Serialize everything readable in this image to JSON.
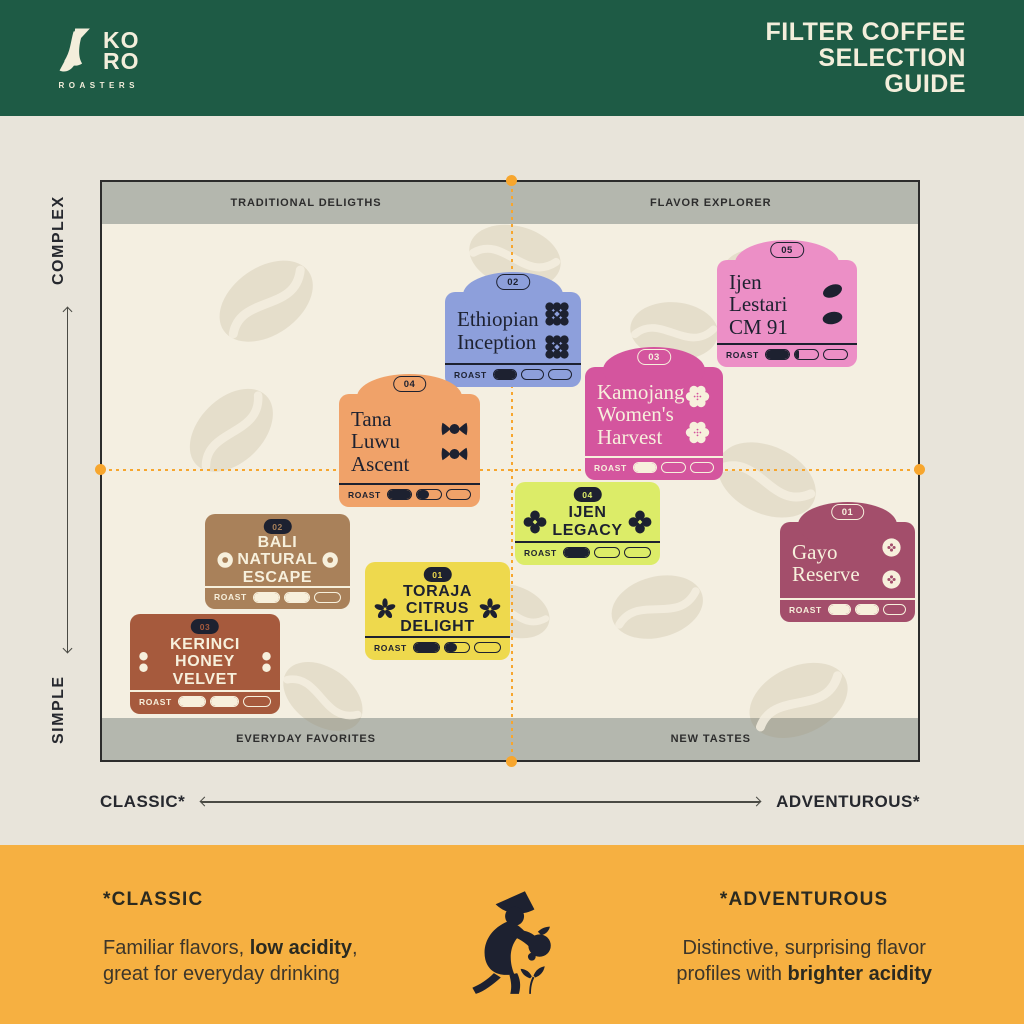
{
  "header": {
    "logo_line1": "KO",
    "logo_line2": "RO",
    "logo_sub": "ROASTERS",
    "title_line1": "FILTER COFFEE",
    "title_line2": "SELECTION",
    "title_line3": "GUIDE"
  },
  "quadrant_labels": {
    "top_left": "TRADITIONAL DELIGTHS",
    "top_right": "FLAVOR EXPLORER",
    "bottom_left": "EVERYDAY FAVORITES",
    "bottom_right": "NEW TASTES"
  },
  "axis": {
    "y_top": "COMPLEX",
    "y_bottom": "SIMPLE",
    "x_left": "CLASSIC*",
    "x_right": "ADVENTUROUS*"
  },
  "roast_label": "ROAST",
  "cards": [
    {
      "id": "ethiopian-inception",
      "badge": "02",
      "name_lines": [
        "Ethiopian",
        "Inception"
      ],
      "roast": [
        1,
        0,
        0
      ],
      "quadrant": "top-center",
      "color": "#8d9fdb",
      "icon": "domino-icon"
    },
    {
      "id": "ijen-lestari-cm-91",
      "badge": "05",
      "name_lines": [
        "Ijen",
        "Lestari",
        "CM 91"
      ],
      "roast": [
        1,
        0.2,
        0
      ],
      "quadrant": "top-right",
      "color": "#ec8fc6",
      "icon": "coffee-bean-icon"
    },
    {
      "id": "kamojang-womens-harvest",
      "badge": "03",
      "name_lines": [
        "Kamojang",
        "Women's",
        "Harvest"
      ],
      "roast": [
        1,
        0,
        0
      ],
      "quadrant": "top-right",
      "color": "#d4559e",
      "icon": "blossom-icon"
    },
    {
      "id": "tana-luwu-ascent",
      "badge": "04",
      "name_lines": [
        "Tana",
        "Luwu",
        "Ascent"
      ],
      "roast": [
        1,
        0.5,
        0
      ],
      "quadrant": "top-left",
      "color": "#f0a269",
      "icon": "candy-icon"
    },
    {
      "id": "ijen-legacy",
      "badge": "04",
      "name_lines": [
        "IJEN",
        "LEGACY"
      ],
      "roast": [
        1,
        0,
        0
      ],
      "quadrant": "bottom-right",
      "color": "#dcec68",
      "icon": "clover-icon"
    },
    {
      "id": "bali-natural-escape",
      "badge": "02",
      "name_lines": [
        "BALI",
        "NATURAL",
        "ESCAPE"
      ],
      "roast": [
        1,
        1,
        0
      ],
      "quadrant": "bottom-left",
      "color": "#a9815a",
      "icon": "donut-icon"
    },
    {
      "id": "gayo-reserve",
      "badge": "01",
      "name_lines": [
        "Gayo",
        "Reserve"
      ],
      "roast": [
        1,
        1,
        0
      ],
      "quadrant": "bottom-right",
      "color": "#a34e6b",
      "icon": "button-icon"
    },
    {
      "id": "toraja-citrus-delight",
      "badge": "01",
      "name_lines": [
        "TORAJA",
        "CITRUS",
        "DELIGHT"
      ],
      "roast": [
        1,
        0.5,
        0
      ],
      "quadrant": "bottom-left",
      "color": "#eed94d",
      "icon": "pinwheel-icon"
    },
    {
      "id": "kerinci-honey-velvet",
      "badge": "03",
      "name_lines": [
        "KERINCI",
        "HONEY",
        "VELVET"
      ],
      "roast": [
        1,
        1,
        0
      ],
      "quadrant": "bottom-left",
      "color": "#a65a3d",
      "icon": "double-dot-icon"
    }
  ],
  "footer": {
    "classic_title": "*CLASSIC",
    "classic_body_1": "Familiar flavors, ",
    "classic_body_bold": "low acidity",
    "classic_body_2": ",",
    "classic_body_line2": "great for everyday drinking",
    "adventurous_title": "*ADVENTUROUS",
    "adventurous_body_line1": "Distinctive, surprising flavor",
    "adventurous_body_2": "profiles with ",
    "adventurous_body_bold": "brighter acidity"
  },
  "colors": {
    "header_green": "#1e5b45",
    "cream": "#f3eedb",
    "page_background": "#e8e4da",
    "chart_background": "#f4efe1",
    "quadrant_band": "#b4b7ae",
    "accent_orange": "#f7a62e",
    "footer_orange": "#f6b041",
    "ink_dark": "#1d2130"
  }
}
